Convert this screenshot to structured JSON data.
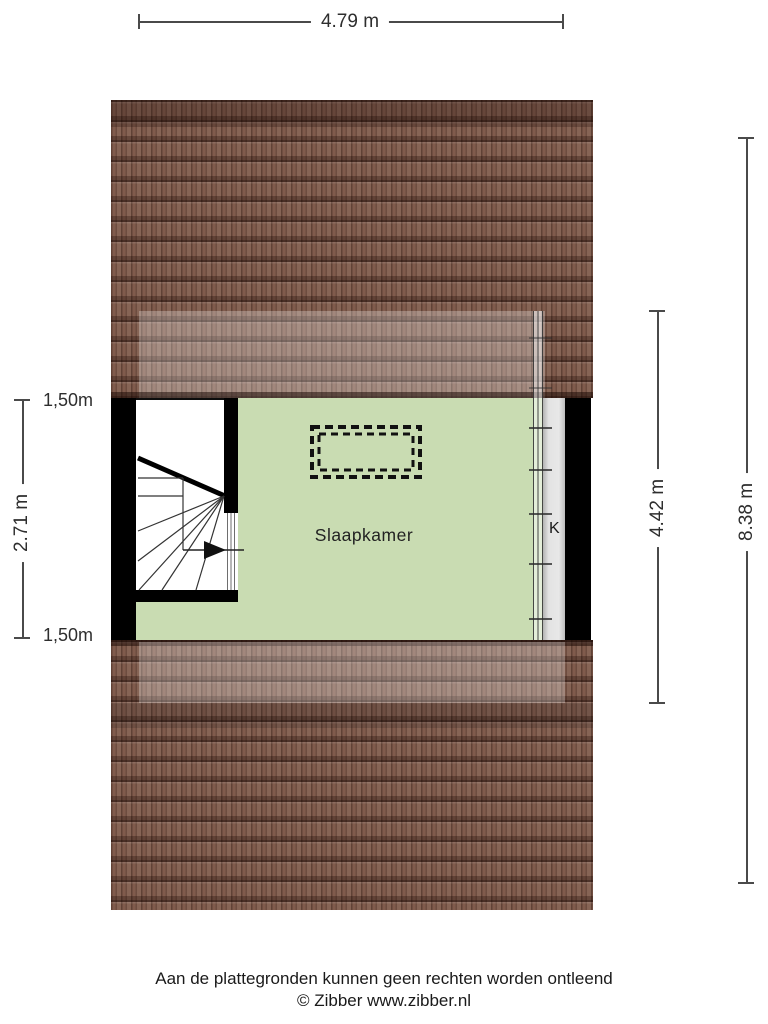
{
  "plan": {
    "room_label": "Slaapkamer",
    "k_label": "K"
  },
  "dimensions": {
    "width_top": "4.79 m",
    "left_height": "2.71 m",
    "left_top_seg": "1,50m",
    "left_bottom_seg": "1,50m",
    "inner_height": "4.42 m",
    "total_height": "8.38 m"
  },
  "footer": {
    "disclaimer": "Aan de plattegronden kunnen geen rechten worden ontleend",
    "credit": "© Zibber www.zibber.nl"
  },
  "colors": {
    "room_fill": "#c9dcb2",
    "roof_base": "#7d5849",
    "wall": "#000000",
    "background": "#ffffff",
    "dimension_line": "#4a4a4a"
  }
}
